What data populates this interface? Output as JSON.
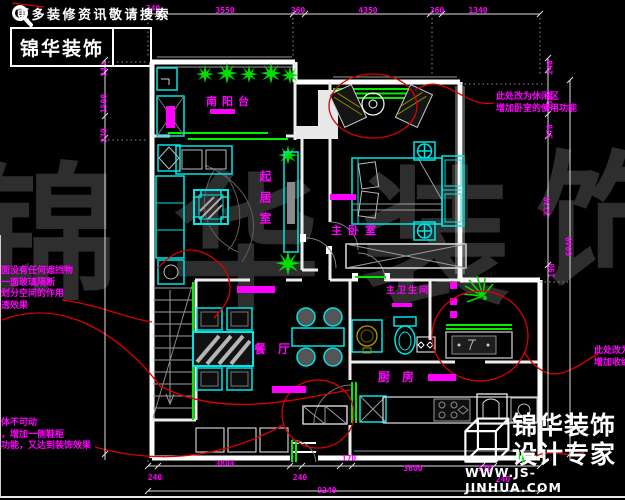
{
  "canvas": {
    "width": 625,
    "height": 500
  },
  "colors": {
    "background": "#000000",
    "wall": "#ffffff",
    "furniture": "#00ffff",
    "door_and_plant": "#00ff00",
    "dimension_text": "#ff00ff",
    "annotation_line": "#dd0000",
    "watermark": "#2e2e2e"
  },
  "header": {
    "tagline": "更多装修资讯敬请搜索",
    "brand": "锦华装饰",
    "search_icon": "magnifier"
  },
  "footer": {
    "brand": "锦华装饰",
    "subtitle": "设计专家",
    "website": "WWW.JS-JINHUA.COM",
    "logo_icon": "wireframe-cube"
  },
  "watermark": {
    "chars": [
      "锦",
      "华",
      "装",
      "饰"
    ]
  },
  "rooms": {
    "balcony": {
      "label": "南阳台"
    },
    "living": {
      "label": "起居室"
    },
    "bedroom": {
      "label": "主卧室"
    },
    "bathroom": {
      "label": "主卫生间"
    },
    "dining": {
      "label": "餐厅"
    },
    "kitchen": {
      "label": "厨房"
    }
  },
  "notes": {
    "leisure": [
      "此处改为休闲区",
      "增加卧室的使用功能"
    ],
    "glass": [
      "前面没有任何遮挡物",
      "加一面玻璃隔断",
      "起划分空间的作用",
      "通透效果"
    ],
    "shoe": [
      "墙体不可动",
      "式，增加一侧鞋柜",
      "用功能，又达到装饰效果"
    ],
    "right": [
      "此处改为",
      "增加收纳"
    ]
  },
  "dims": {
    "top": [
      "240",
      "3550",
      "360",
      "4350",
      "360",
      "1340"
    ],
    "bottom": [
      "240",
      "3804",
      "240",
      "170",
      "3600",
      "170",
      "240"
    ],
    "total": "9240",
    "left": [
      "240",
      "1500",
      "370"
    ],
    "right": [
      "240",
      "1500",
      "370",
      "3230",
      "190",
      "6040"
    ]
  }
}
